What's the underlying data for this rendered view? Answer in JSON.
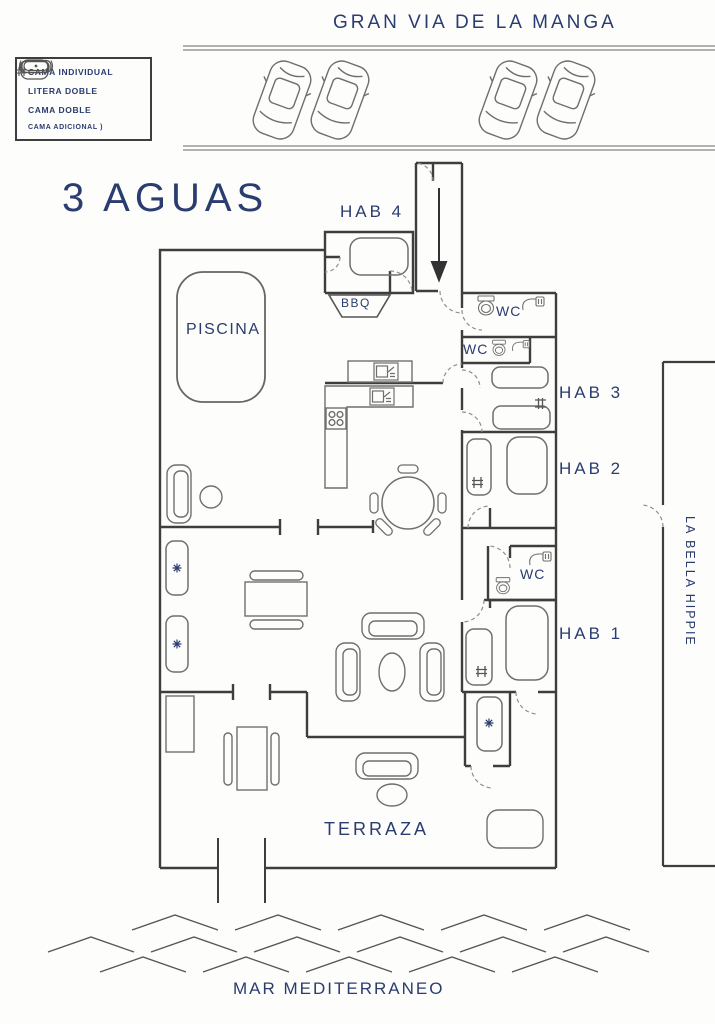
{
  "title": "3 AGUAS",
  "streets": {
    "top": "GRAN VIA DE LA MANGA",
    "sea": "MAR MEDITERRANEO",
    "neighbor": "LA BELLA HIPPIE"
  },
  "legend": {
    "items": [
      {
        "icon": "single-bed-icon",
        "label": "CAMA INDIVIDUAL"
      },
      {
        "icon": "bunk-bed-icon",
        "label": "LITERA DOBLE"
      },
      {
        "icon": "double-bed-icon",
        "label": "CAMA DOBLE"
      },
      {
        "icon": "extra-bed-icon",
        "label": "CAMA ADICIONAL )"
      }
    ]
  },
  "rooms": {
    "hab4": "HAB 4",
    "bbq": "BBQ",
    "wc_top": "WC",
    "wc_mid": "WC",
    "hab3": "HAB 3",
    "hab2": "HAB 2",
    "wc_lower": "WC",
    "hab1": "HAB 1",
    "piscina": "PISCINA",
    "terraza": "TERRAZA"
  },
  "colors": {
    "ink": "#2a3c70",
    "walls": "#3e3e3e",
    "furniture": "#6f6f6f"
  }
}
